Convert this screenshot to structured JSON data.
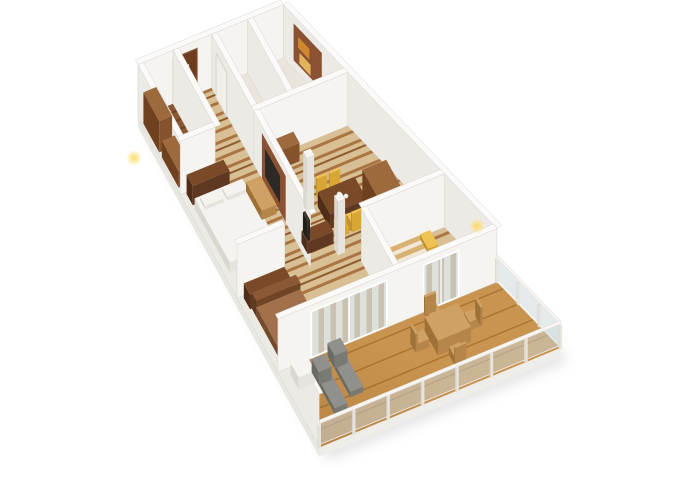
{
  "scene": {
    "kind": "3d-floorplan-render",
    "background": "#ffffff",
    "projection": {
      "ox": 138,
      "oy": 118,
      "ex": [
        0.92,
        -0.38
      ],
      "ey": [
        0.44,
        0.8
      ],
      "ez": 0.92
    },
    "colors": {
      "zBase": "#d8bf94",
      "zS1": "#aa7543",
      "zS2": "#8f5c2e",
      "plBase": "#8a5832",
      "plDark": "#6f4420",
      "deckBase": "#c9944f",
      "deckLine": "#aa7634",
      "cCream": "#efe8db",
      "cTan": "#c9ad85",
      "bsTan": "#d9b271",
      "bsCream": "#f1e8d8",
      "bathFloor": "#e9e5dd",
      "wallFaceY": "#f5f4f1",
      "wallFaceX": "#eceae5",
      "wallTop": "#fbfaf8",
      "wallEdge": "#d8d5cf",
      "fascia": "#efedea",
      "slabSide": "#e9e7e2",
      "glass": "rgba(204,216,220,0.5)",
      "glassFrame": "#ffffff",
      "doorBrown": "#6e3c1e",
      "doorFrame": "#93653f",
      "doorSign": "#f2efe9",
      "panelWood": "#8a5233",
      "tvDark": "#2d2925",
      "towelO": "#d0882e",
      "towelT": "#e2b35c",
      "accent": "#c04a1d",
      "shadow": "rgba(0,0,0,0.10)",
      "glow": "#ffd95e",
      "cupFill": "#f3f1ec",
      "cupEdge": "#c9c4ba"
    },
    "triples": {
      "wood": [
        "#9c6a3c",
        "#84522b",
        "#6f411f"
      ],
      "woodDark": [
        "#7a4a28",
        "#5f3822",
        "#4f2d18"
      ],
      "whiteF": [
        "#f6f4f0",
        "#e7e4de",
        "#dbd8d1"
      ],
      "yellow": [
        "#eec253",
        "#d8a634",
        "#c1912a"
      ],
      "grayL": [
        "#90908c",
        "#7a7a74",
        "#6b6b65"
      ],
      "tanW": [
        "#cfa263",
        "#b5854a",
        "#9e7138"
      ],
      "tvDark3": [
        "#3a3530",
        "#2c2824",
        "#232019"
      ],
      "bedW": [
        "#f5f3ef",
        "#e6e3dd",
        "#dad7d0"
      ],
      "sofa": [
        "#8a5a36",
        "#6f4526",
        "#5e3a1f"
      ],
      "sofaSeat": [
        "#a0714a",
        "#875a38",
        "#734a2c"
      ],
      "stripeBed": [
        "#d9b271",
        "#b5854a",
        "#9e7138"
      ]
    },
    "items": [
      {
        "k": "shadow",
        "name": "ground-shadow",
        "pts": [
          [
            0,
            0
          ],
          [
            158,
            0
          ],
          [
            262,
            412
          ],
          [
            0,
            412
          ]
        ]
      },
      {
        "k": "poly",
        "name": "interior-floor",
        "pts": [
          [
            0,
            0
          ],
          [
            158,
            0
          ],
          [
            238,
            318
          ],
          [
            0,
            318
          ]
        ],
        "f": "zebra"
      },
      {
        "k": "poly",
        "name": "closet-floor",
        "pts": [
          [
            0,
            0
          ],
          [
            38,
            0
          ],
          [
            38,
            96
          ],
          [
            0,
            96
          ]
        ],
        "f": "plank"
      },
      {
        "k": "poly",
        "name": "shower-room-floor",
        "pts": [
          [
            80,
            0
          ],
          [
            119,
            0
          ],
          [
            119,
            96
          ],
          [
            80,
            96
          ]
        ],
        "f": "bathFloor"
      },
      {
        "k": "poly",
        "name": "bathroom-floor",
        "pts": [
          [
            119,
            0
          ],
          [
            158,
            0
          ],
          [
            182,
            96
          ],
          [
            119,
            96
          ]
        ],
        "f": "bathFloor"
      },
      {
        "k": "poly",
        "name": "balcony-deck",
        "pts": [
          [
            0,
            318
          ],
          [
            238,
            318
          ],
          [
            262,
            412
          ],
          [
            0,
            412
          ]
        ],
        "f": "deckp"
      },
      {
        "k": "poly",
        "name": "balcony-deck-shading",
        "pts": [
          [
            0,
            318
          ],
          [
            238,
            318
          ],
          [
            262,
            412
          ],
          [
            0,
            412
          ]
        ],
        "f": "deckshade"
      },
      {
        "k": "panel",
        "name": "slab-front-fascia",
        "a": [
          0,
          412
        ],
        "b": [
          262,
          412
        ],
        "z0": -10,
        "z1": 0,
        "f": "fascia"
      },
      {
        "k": "panel",
        "name": "slab-left-face",
        "a": [
          0,
          0
        ],
        "b": [
          0,
          412
        ],
        "z0": -10,
        "z1": 0,
        "f": "slabSide"
      },
      {
        "k": "wall",
        "name": "back-wall",
        "a": [
          0,
          0
        ],
        "b": [
          158,
          0
        ]
      },
      {
        "k": "panel",
        "name": "entry-door",
        "a": [
          38,
          0.8
        ],
        "b": [
          64,
          0.8
        ],
        "z0": 0,
        "z1": 50,
        "f": "doorBrown",
        "s": "doorFrame"
      },
      {
        "k": "panel",
        "name": "entry-door-sign",
        "a": [
          47,
          1.2
        ],
        "b": [
          55,
          1.2
        ],
        "z0": 30,
        "z1": 37,
        "f": "doorSign"
      },
      {
        "k": "wall",
        "name": "left-outer-wall",
        "a": [
          0,
          0
        ],
        "b": [
          0,
          412
        ]
      },
      {
        "k": "wall",
        "name": "closet-corridor-wall",
        "a": [
          38,
          0
        ],
        "b": [
          38,
          96
        ]
      },
      {
        "k": "box",
        "name": "closet-shelf-tall",
        "x": 2,
        "y": 8,
        "w": 14,
        "d": 36,
        "h": 34,
        "c": "wood"
      },
      {
        "k": "box",
        "name": "closet-shelf-low",
        "x": 2,
        "y": 50,
        "w": 14,
        "d": 38,
        "h": 18,
        "c": "wood"
      },
      {
        "k": "wall",
        "name": "corridor-shower-wall",
        "a": [
          80,
          0
        ],
        "b": [
          80,
          96
        ]
      },
      {
        "k": "panel",
        "name": "shower-door",
        "a": [
          79.2,
          12
        ],
        "b": [
          79.2,
          36
        ],
        "z0": 0,
        "z1": 48,
        "f": "doorSign",
        "s": "wallEdge"
      },
      {
        "k": "wall",
        "name": "shower-bath-wall",
        "a": [
          119,
          0
        ],
        "b": [
          119,
          96
        ]
      },
      {
        "k": "box",
        "name": "toilet",
        "x": 124,
        "y": 56,
        "w": 9,
        "d": 12,
        "h": 11,
        "c": "whiteF"
      },
      {
        "k": "wall",
        "name": "right-outer-wall",
        "a": [
          158,
          0
        ],
        "b": [
          238,
          318
        ]
      },
      {
        "k": "panel",
        "name": "bathroom-wood-panel",
        "a": [
          161.5,
          16
        ],
        "b": [
          172,
          58
        ],
        "z0": 10,
        "z1": 50,
        "f": "panelWood"
      },
      {
        "k": "panel",
        "name": "bathroom-towel-orange",
        "a": [
          163.5,
          22
        ],
        "b": [
          167.5,
          39
        ],
        "z0": 28,
        "z1": 40,
        "f": "towelO"
      },
      {
        "k": "panel",
        "name": "bathroom-towel-tan",
        "a": [
          164,
          24
        ],
        "b": [
          168,
          41
        ],
        "z0": 12,
        "z1": 24,
        "f": "towelT"
      },
      {
        "k": "wall",
        "name": "closet-front-wall",
        "a": [
          0,
          96
        ],
        "b": [
          38,
          96
        ]
      },
      {
        "k": "wall",
        "name": "bathroom-front-wall",
        "a": [
          80,
          96
        ],
        "b": [
          182,
          96
        ]
      },
      {
        "k": "box",
        "name": "writing-desk",
        "x": 86,
        "y": 98,
        "w": 36,
        "d": 14,
        "h": 20,
        "c": "wood"
      },
      {
        "k": "chair",
        "name": "desk-chair",
        "x": 94,
        "y": 116,
        "w": 9,
        "d": 9,
        "dir": "s",
        "c": "yellow"
      },
      {
        "k": "wall",
        "name": "master-bedroom-wall",
        "a": [
          80,
          96
        ],
        "b": [
          80,
          225
        ]
      },
      {
        "k": "panel",
        "name": "master-tv-wood-panel",
        "a": [
          79.2,
          116
        ],
        "b": [
          79.2,
          170
        ],
        "z0": 2,
        "z1": 52,
        "f": "panelWood"
      },
      {
        "k": "panel",
        "name": "master-tv",
        "a": [
          78.9,
          124
        ],
        "b": [
          78.9,
          158
        ],
        "z0": 12,
        "z1": 42,
        "f": "tvDark"
      },
      {
        "k": "box",
        "name": "master-dresser",
        "x": 6,
        "y": 98,
        "w": 40,
        "d": 14,
        "h": 21,
        "c": "woodDark"
      },
      {
        "k": "box",
        "name": "master-bed",
        "x": 6,
        "y": 116,
        "w": 52,
        "d": 80,
        "h": 11,
        "c": "bedW"
      },
      {
        "k": "box",
        "name": "master-pillow-left",
        "x": 10,
        "y": 120,
        "w": 20,
        "d": 12,
        "h": 4,
        "z0": 11,
        "c": "bedW"
      },
      {
        "k": "box",
        "name": "master-pillow-right",
        "x": 34,
        "y": 120,
        "w": 20,
        "d": 12,
        "h": 4,
        "z0": 11,
        "c": "bedW"
      },
      {
        "k": "box",
        "name": "master-bench",
        "x": 60,
        "y": 120,
        "w": 16,
        "d": 36,
        "h": 10,
        "c": "tanW"
      },
      {
        "k": "chair",
        "name": "dining-chair-1",
        "x": 120,
        "y": 156,
        "w": 11,
        "d": 10,
        "dir": "n",
        "c": "yellow"
      },
      {
        "k": "chair",
        "name": "dining-chair-2",
        "x": 134,
        "y": 156,
        "w": 11,
        "d": 10,
        "dir": "n",
        "c": "yellow"
      },
      {
        "k": "box",
        "name": "dining-table",
        "x": 116,
        "y": 166,
        "w": 40,
        "d": 28,
        "h": 16,
        "c": "woodDark"
      },
      {
        "k": "cup",
        "name": "table-cup-1",
        "x": 134,
        "y": 177,
        "z": 16
      },
      {
        "k": "cup",
        "name": "table-cup-2",
        "x": 139,
        "y": 182,
        "z": 16
      },
      {
        "k": "chair",
        "name": "dining-chair-3",
        "x": 120,
        "y": 194,
        "w": 11,
        "d": 10,
        "dir": "s",
        "c": "yellow"
      },
      {
        "k": "chair",
        "name": "dining-chair-4",
        "x": 134,
        "y": 194,
        "w": 11,
        "d": 10,
        "dir": "s",
        "c": "yellow"
      },
      {
        "k": "box",
        "name": "column-a",
        "x": 104,
        "y": 158,
        "w": 8,
        "d": 8,
        "h": 58,
        "c": "whiteF"
      },
      {
        "k": "box",
        "name": "tv-sideboard",
        "x": 84,
        "y": 196,
        "w": 28,
        "d": 14,
        "h": 13,
        "c": "woodDark"
      },
      {
        "k": "box",
        "name": "living-tv",
        "x": 84.5,
        "y": 198,
        "w": 2.5,
        "d": 11,
        "h": 22,
        "z0": 13,
        "c": "tvDark3"
      },
      {
        "k": "box",
        "name": "column-b",
        "x": 110,
        "y": 216,
        "w": 8,
        "d": 8,
        "h": 58,
        "c": "whiteF"
      },
      {
        "k": "box",
        "name": "wardrobe",
        "x": 152,
        "y": 192,
        "w": 26,
        "d": 46,
        "h": 48,
        "c": "wood"
      },
      {
        "k": "chair",
        "name": "armchair-yellow",
        "x": 182,
        "y": 200,
        "w": 10,
        "d": 10,
        "dir": "e",
        "c": "yellow"
      },
      {
        "k": "box",
        "name": "stool-yellow-hall",
        "x": 162,
        "y": 244,
        "w": 9,
        "d": 9,
        "h": 8,
        "c": "yellow"
      },
      {
        "k": "wall",
        "name": "master-front-wall",
        "a": [
          0,
          225
        ],
        "b": [
          52,
          225
        ]
      },
      {
        "k": "box",
        "name": "media-sideboard",
        "x": 6,
        "y": 228,
        "w": 44,
        "d": 14,
        "h": 16,
        "c": "woodDark"
      },
      {
        "k": "panel",
        "name": "sideboard-accent",
        "a": [
          14,
          242.9
        ],
        "b": [
          30,
          242.9
        ],
        "z0": 4,
        "z1": 12,
        "f": "accent"
      },
      {
        "k": "box",
        "name": "sofa-back",
        "x": 8,
        "y": 242,
        "w": 48,
        "d": 10,
        "h": 17,
        "c": "sofa"
      },
      {
        "k": "box",
        "name": "sofa-seat",
        "x": 8,
        "y": 252,
        "w": 48,
        "d": 18,
        "h": 10,
        "c": "sofaSeat"
      },
      {
        "k": "box",
        "name": "sofa-chaise",
        "x": 8,
        "y": 270,
        "w": 22,
        "d": 36,
        "h": 10,
        "c": "sofaSeat"
      },
      {
        "k": "box",
        "name": "coffee-table",
        "x": 38,
        "y": 276,
        "w": 26,
        "d": 22,
        "h": 9,
        "c": "woodDark"
      },
      {
        "k": "box",
        "name": "side-stool-base",
        "x": 18,
        "y": 304,
        "w": 12,
        "d": 12,
        "h": 6,
        "c": "tvDark3"
      },
      {
        "k": "box",
        "name": "side-stool-cushion",
        "x": 19,
        "y": 305,
        "w": 10,
        "d": 10,
        "h": 3,
        "z0": 6,
        "c": "yellow"
      },
      {
        "k": "wall",
        "name": "bedroom2-back-wall",
        "a": [
          128,
          240
        ],
        "b": [
          218,
          240
        ]
      },
      {
        "k": "box",
        "name": "bed2",
        "x": 134,
        "y": 248,
        "w": 64,
        "d": 48,
        "h": 11,
        "c": "stripeBed",
        "tf": "bedstripe"
      },
      {
        "k": "box",
        "name": "bed2-pillow-1",
        "x": 186,
        "y": 252,
        "w": 11,
        "d": 18,
        "h": 5,
        "z0": 11,
        "c": "yellow"
      },
      {
        "k": "box",
        "name": "bed2-pillow-2",
        "x": 186,
        "y": 274,
        "w": 11,
        "d": 18,
        "h": 5,
        "z0": 11,
        "c": "yellow"
      },
      {
        "k": "wall",
        "name": "bedroom2-side-wall",
        "a": [
          128,
          240
        ],
        "b": [
          128,
          318
        ]
      },
      {
        "k": "box",
        "name": "stool-yellow-nook",
        "x": 114,
        "y": 296,
        "w": 9,
        "d": 9,
        "h": 8,
        "c": "yellow"
      },
      {
        "k": "wall",
        "name": "front-wall",
        "a": [
          0,
          318
        ],
        "b": [
          238,
          318
        ]
      },
      {
        "k": "glass",
        "name": "living-room-slider",
        "x1": 36,
        "x2": 118
      },
      {
        "k": "glass",
        "name": "bedroom2-slider",
        "x1": 158,
        "x2": 196
      },
      {
        "k": "bal",
        "name": "balcony-right-balustrade",
        "a": [
          238,
          318
        ],
        "b": [
          262,
          412
        ],
        "n": 3
      },
      {
        "k": "box",
        "name": "balcony-side-table",
        "x": 10,
        "y": 326,
        "w": 18,
        "d": 18,
        "h": 13,
        "c": "whiteF"
      },
      {
        "k": "lounger",
        "name": "lounger-2",
        "x": 52,
        "y": 322
      },
      {
        "k": "lounger",
        "name": "lounger-1",
        "x": 30,
        "y": 332
      },
      {
        "k": "chair",
        "name": "patio-chair-top",
        "x": 158,
        "y": 322,
        "w": 12,
        "d": 12,
        "dir": "n",
        "c": "tanW"
      },
      {
        "k": "chair",
        "name": "patio-chair-right",
        "x": 190,
        "y": 344,
        "w": 12,
        "d": 12,
        "dir": "e",
        "c": "tanW"
      },
      {
        "k": "box",
        "name": "patio-table",
        "x": 150,
        "y": 338,
        "w": 36,
        "d": 30,
        "h": 16,
        "c": "tanW"
      },
      {
        "k": "chair",
        "name": "patio-chair-left",
        "x": 134,
        "y": 344,
        "w": 12,
        "d": 12,
        "dir": "w",
        "c": "tanW"
      },
      {
        "k": "chair",
        "name": "patio-chair-bottom",
        "x": 160,
        "y": 372,
        "w": 12,
        "d": 12,
        "dir": "s",
        "c": "tanW"
      },
      {
        "k": "bal",
        "name": "balcony-front-balustrade",
        "a": [
          0,
          412
        ],
        "b": [
          262,
          412
        ],
        "n": 7
      },
      {
        "k": "dot",
        "name": "wall-lamp-glow-1",
        "cx": 134,
        "cy": 158
      },
      {
        "k": "dot",
        "name": "wall-lamp-glow-2",
        "cx": 477,
        "cy": 226
      }
    ]
  }
}
